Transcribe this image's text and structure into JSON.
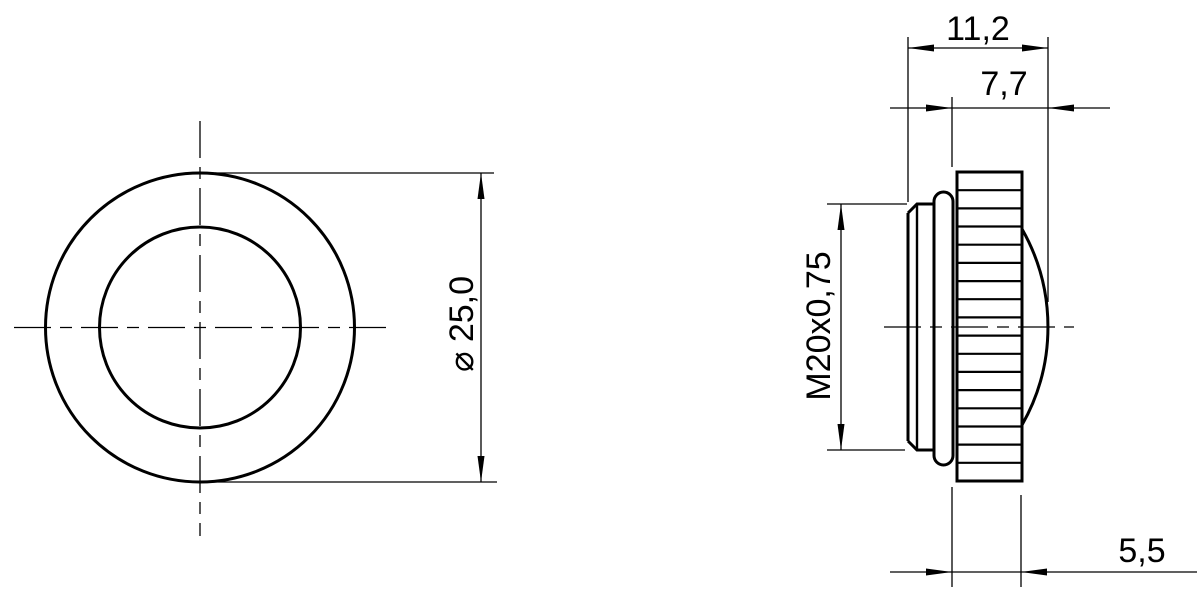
{
  "colors": {
    "line": "#000000",
    "background": "#ffffff"
  },
  "front_view": {
    "diameter_dim": "⌀ 25,0"
  },
  "side_view": {
    "overall_depth_dim": "11,2",
    "front_depth_dim": "7,7",
    "thread_dim": "M20x0,75",
    "knurl_width_dim": "5,5"
  }
}
